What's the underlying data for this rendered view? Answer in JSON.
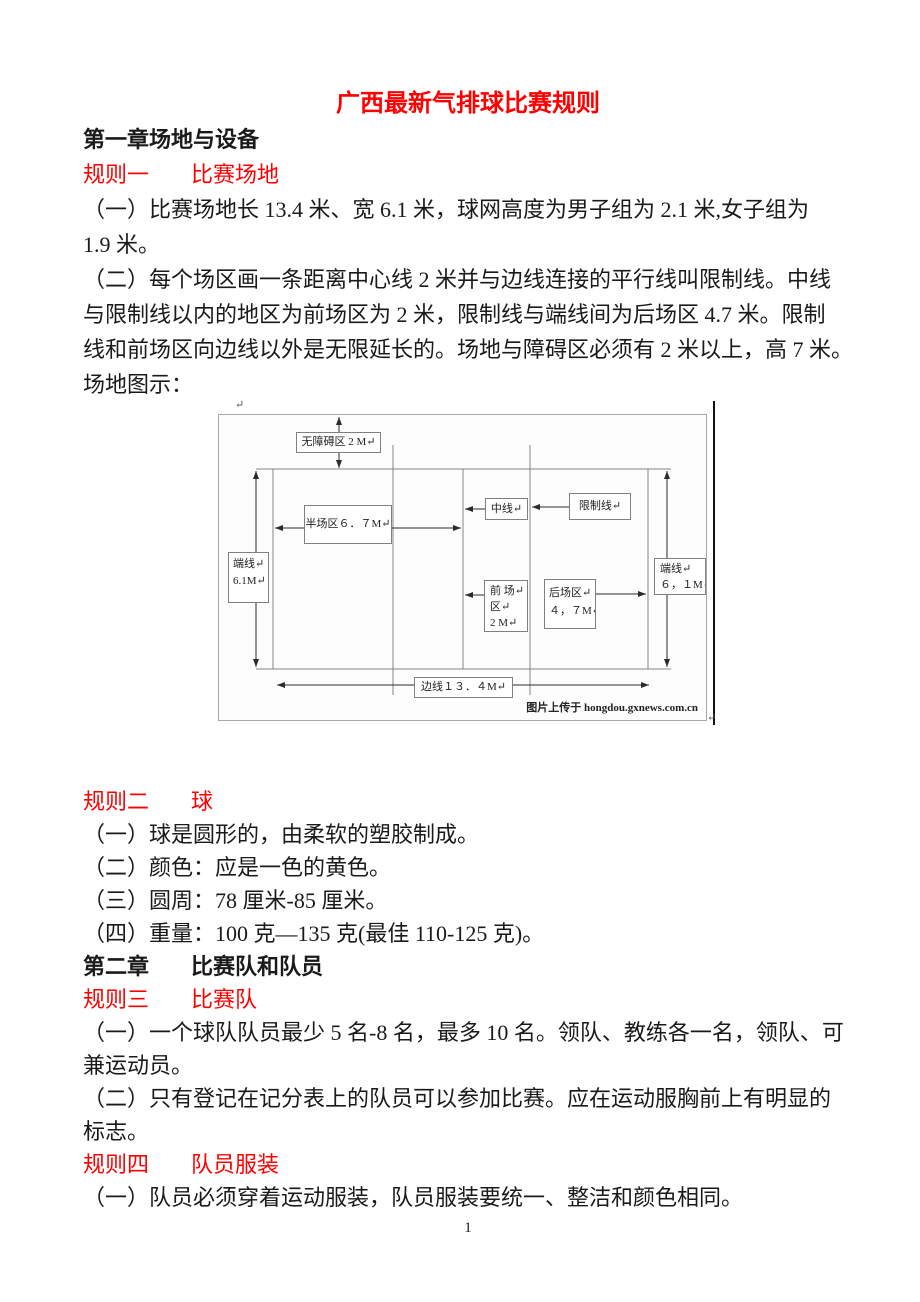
{
  "title": "广西最新气排球比赛规则",
  "page_number": "1",
  "colors": {
    "heading_red": "#ff0000",
    "body_text": "#1a1a1a",
    "diagram_structure_line": "#858585",
    "diagram_arrow": "#2b2b2b",
    "figure_border": "#a8a8a8"
  },
  "body": {
    "chapter1_heading": "第一章场地与设备",
    "rule1_label": "规则一",
    "rule1_title": "比赛场地",
    "p1_l1": "（一）比赛场地长 13.4 米、宽 6.1 米，球网高度为男子组为 2.1 米,女子组为",
    "p1_l2": "1.9 米。",
    "p2_l1": "（二）每个场区画一条距离中心线 2 米并与边线连接的平行线叫限制线。中线",
    "p2_l2": "与限制线以内的地区为前场区为 2 米，限制线与端线间为后场区 4.7 米。限制",
    "p2_l3": "线和前场区向边线以外是无限延长的。场地与障碍区必须有 2 米以上，高 7 米。",
    "p3": "场地图示：",
    "rule2_label": "规则二",
    "rule2_title": "球",
    "rule2_i1": "（一）球是圆形的，由柔软的塑胶制成。",
    "rule2_i2": "（二）颜色：应是一色的黄色。",
    "rule2_i3": "（三）圆周：78 厘米-85 厘米。",
    "rule2_i4": "（四）重量：100 克—135 克(最佳 110-125 克)。",
    "chapter2_label": "第二章",
    "chapter2_title": "比赛队和队员",
    "rule3_label": "规则三",
    "rule3_title": "比赛队",
    "rule3_l1": "（一）一个球队队员最少 5 名-8 名，最多 10 名。领队、教练各一名，领队、可",
    "rule3_l2": "兼运动员。",
    "rule3_l3": "（二）只有登记在记分表上的队员可以参加比赛。应在运动服胸前上有明显的",
    "rule3_l4": "标志。",
    "rule4_label": "规则四",
    "rule4_title": "队员服装",
    "rule4_l1": "（一）队员必须穿着运动服装，队员服装要统一、整洁和颜色相同。"
  },
  "diagram": {
    "return_mark": "↵",
    "no_obstacle_zone": "无障碍区 2 M↵",
    "half_court": "半场区６．７M↵",
    "center_line": "中线↵",
    "restriction_line": "限制线↵",
    "endline_left_1": "端线↵",
    "endline_left_2": "6.1M↵",
    "endline_right_1": "端线↵",
    "endline_right_2": "６，１M↵",
    "front_zone_1": "前 场↵",
    "front_zone_2": "区↵",
    "front_zone_3": "2 M↵",
    "back_zone_1": "后场区↵",
    "back_zone_2": "４，７M↵",
    "sideline": "边线１３．４M↵",
    "caption": "图片上传于 hongdou.gxnews.com.cn"
  }
}
